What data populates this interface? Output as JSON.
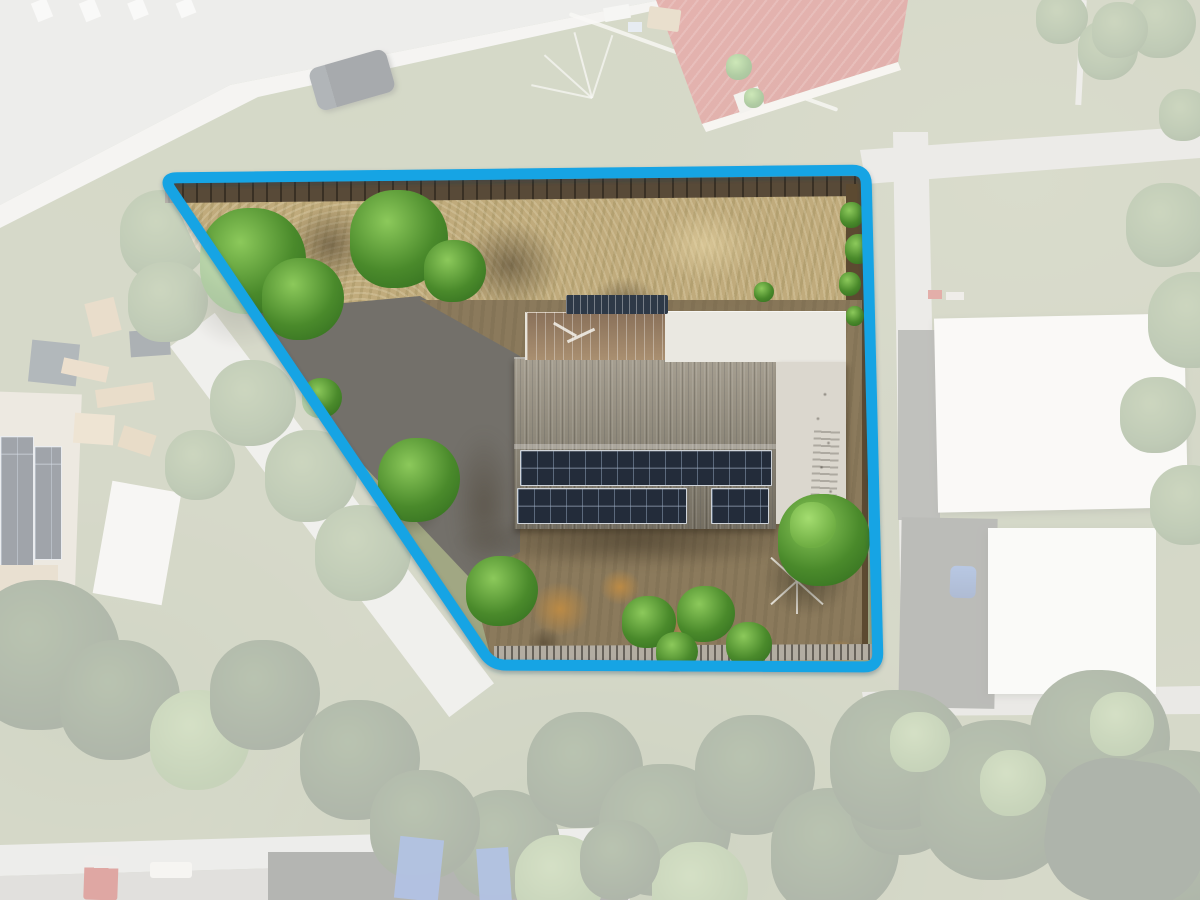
{
  "meta": {
    "type": "aerial-drone-property-photo",
    "width": 1200,
    "height": 900,
    "description": "Top-down aerial photograph of a residential lot; surroundings are whitened/faded and the subject lot is outlined in blue and shown in full colour."
  },
  "boundary": {
    "points": [
      [
        163,
        178
      ],
      [
        866,
        170
      ],
      [
        878,
        667
      ],
      [
        492,
        665
      ]
    ],
    "corner_radius": 14,
    "stroke_width": 11,
    "color": "#16a4e4",
    "shadow_color": "#123a52",
    "mask_color": "#ffffff",
    "mask_opacity": 0.57
  },
  "palette": {
    "grass_base": "#a1a783",
    "dry_grass": "#c0ab7c",
    "dirt": "#8b7a5c",
    "gravel_drive": "#73706a",
    "road": "#d6d5d1",
    "footpath": "#dddcd6",
    "roof_main": "#8f897b",
    "solar_panel": "#232c3a",
    "greenhouse_rust": "#a98f70",
    "roof_white": "#eae8e1",
    "roof_red": "#c24b40",
    "building_white": "#f3f2ed",
    "tree_bright": "#4a8a2b",
    "tree_olive": "#6d8757",
    "tarp_blue": "#4e74c5"
  },
  "features": {
    "subject_lot": "irregular four-sided lot highlighted by blue boundary",
    "main_house": "grey corrugated roof with two rows of rooftop solar panels",
    "greenhouse": "rusted translucent greenhouse roof beside rear white metal roof",
    "solar_water_heater": "dark navy rooftop unit at ridge",
    "side_annex": "light annex roof on right side of house",
    "clothesline": "rotary clothesline in rear yard",
    "front_yard": "dry straw-coloured grass with green trees",
    "rear_yard": "bare dirt with orange patches and shrubs",
    "street_top_left": "curved street with pedestrian crossing and parked SUV",
    "neighbor_red_roof": "red tiled hip roof house, top right",
    "neighbor_warehouse": "large white metal roof buildings, right side",
    "neighbor_solar_house": "neighbouring roof with solar panels, left side",
    "rear_lane": "street along bottom left with parked vehicles",
    "vegetation": "dense faded tree canopy across bottom of frame"
  }
}
